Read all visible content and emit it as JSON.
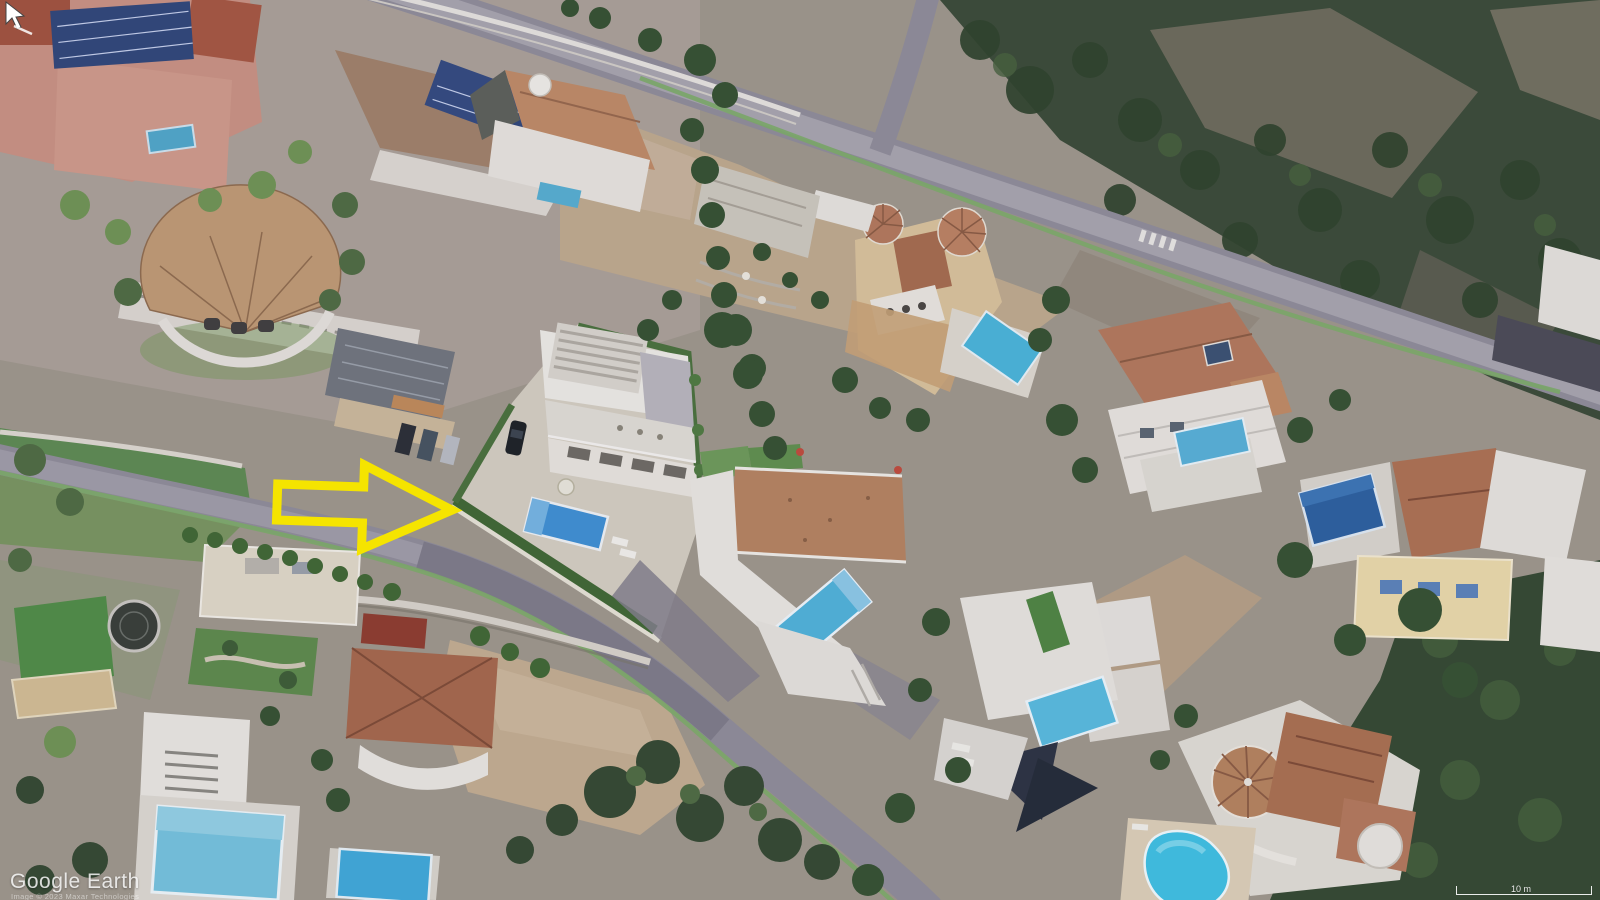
{
  "view": {
    "app_watermark": "Google Earth",
    "attribution": "Image © 2023 Maxar Technologies",
    "scale_label": "10 m"
  },
  "annotation_arrow": {
    "shape": "hollow-right-arrow",
    "color": "#F5E400",
    "direction": "right",
    "points_at": "new-build modern villa with roof terraces, blue pool and hedge-lined plot"
  },
  "cursor": {
    "icon": "mouse-pointer"
  },
  "scene": {
    "type": "aerial-3d-satellite-view",
    "description": "Hillside Mediterranean residential neighborhood with luxury villas, swimming pools, winding roads with painted green lane, pine woodland and rocky slope",
    "highlighted_plot": "white render villa with slatted roof deck, rectangular blue pool, sun loungers, parasol and dark parked car",
    "landmarks": [
      "pink apartment complex with rooftop solar panels",
      "semicircular fan-roof terracotta villa",
      "ochre castle-style villa with conical turret and pool",
      "white villa with terracotta hip roof and pool",
      "modern white villa with diagonal pool",
      "villa with dark shade sails and pool",
      "round-turret villa with kidney-shaped pool",
      "villa with lawn and trampoline",
      "vacant dirt lot with pine cluster",
      "dark woodland band along upper road"
    ],
    "colors": {
      "pool_blue": "#3e8fd2",
      "pool_cyan": "#3ec0e2",
      "terracotta_roof": "#b3785a",
      "white_building": "#e8e5df",
      "vegetation_dark": "#35482f",
      "road_gray": "#8f8c97",
      "bike_lane_green": "#7cab66",
      "dirt_tan": "#c3ad8f"
    }
  }
}
